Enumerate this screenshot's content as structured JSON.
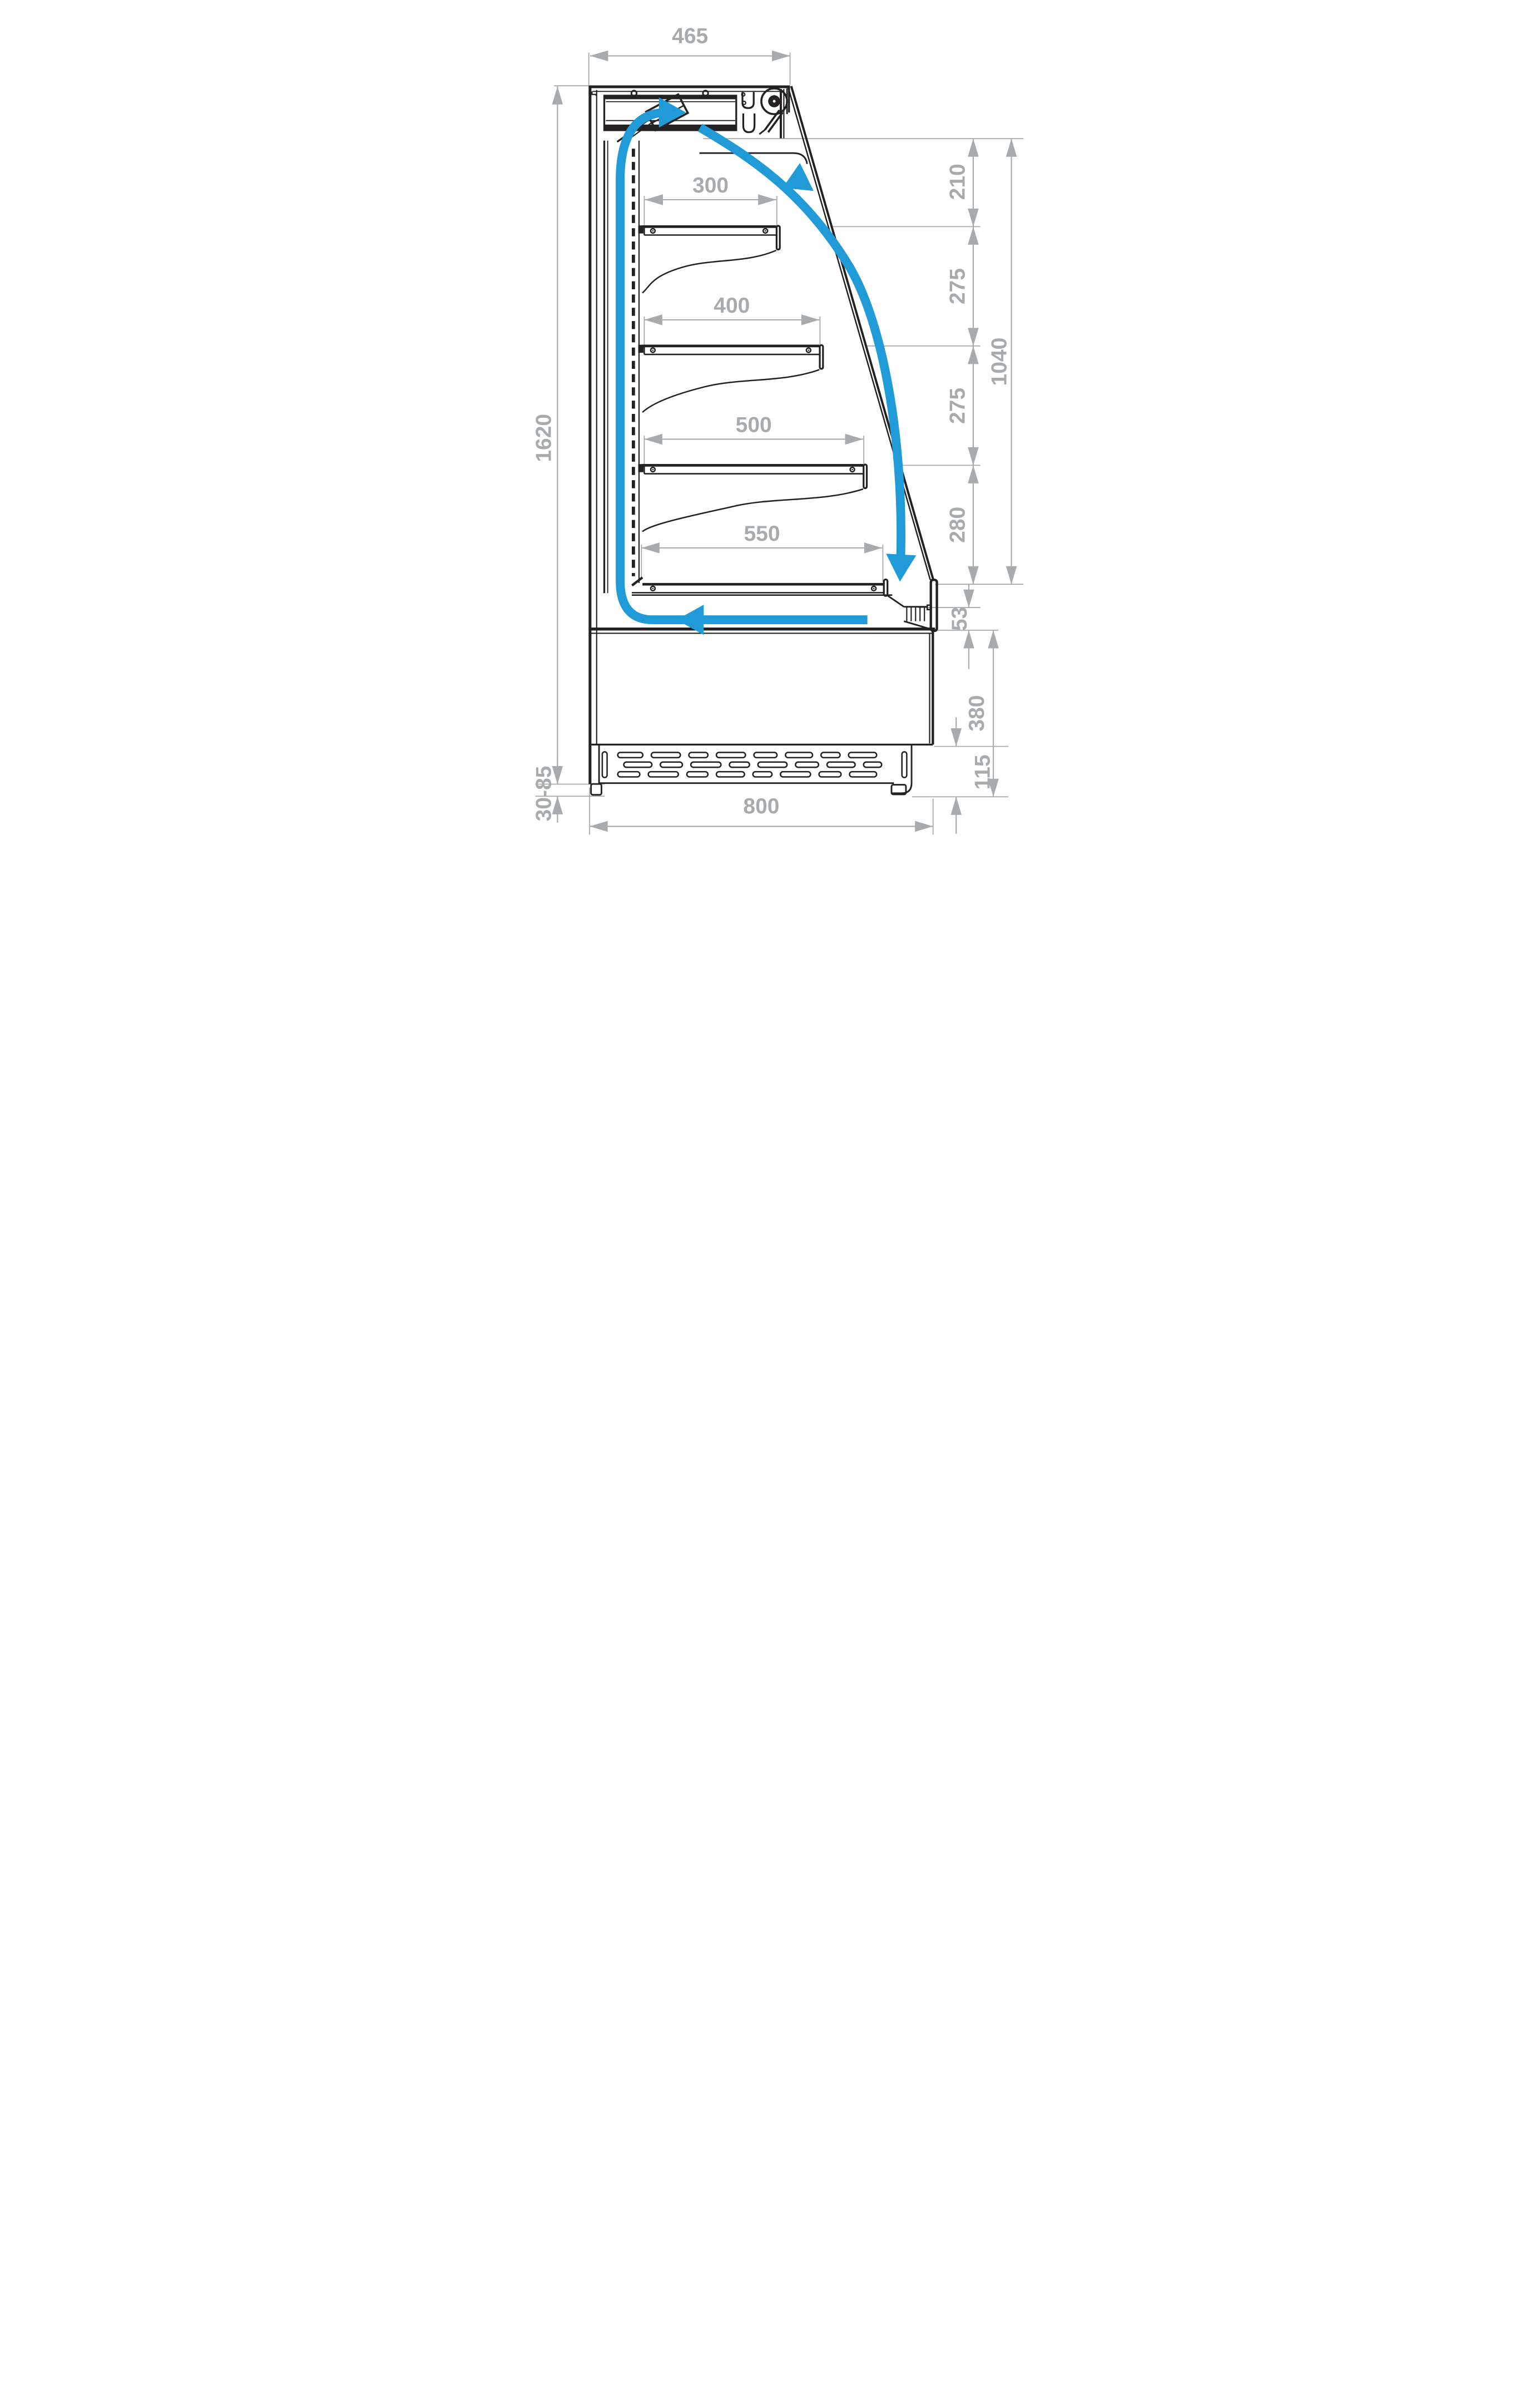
{
  "diagram": {
    "type": "technical-drawing",
    "subject": "Open-front refrigerated display case - side cross-section with air circulation loop and dimensions",
    "units": "mm",
    "colors": {
      "outline": "#242122",
      "dimension": "#a8abad",
      "airflow": "#219bd8",
      "background": "#ffffff"
    },
    "dims": {
      "top_width": "465",
      "overall_height": "1620",
      "foot_adjust": "30-85",
      "overall_depth": "800",
      "shelf1": "300",
      "shelf2": "400",
      "shelf3": "500",
      "shelf4": "550",
      "gap1": "210",
      "gap2": "275",
      "gap3": "275",
      "gap4": "280",
      "opening_height": "1040",
      "intake_gap": "53",
      "base_height": "380",
      "plinth_height": "115"
    }
  }
}
